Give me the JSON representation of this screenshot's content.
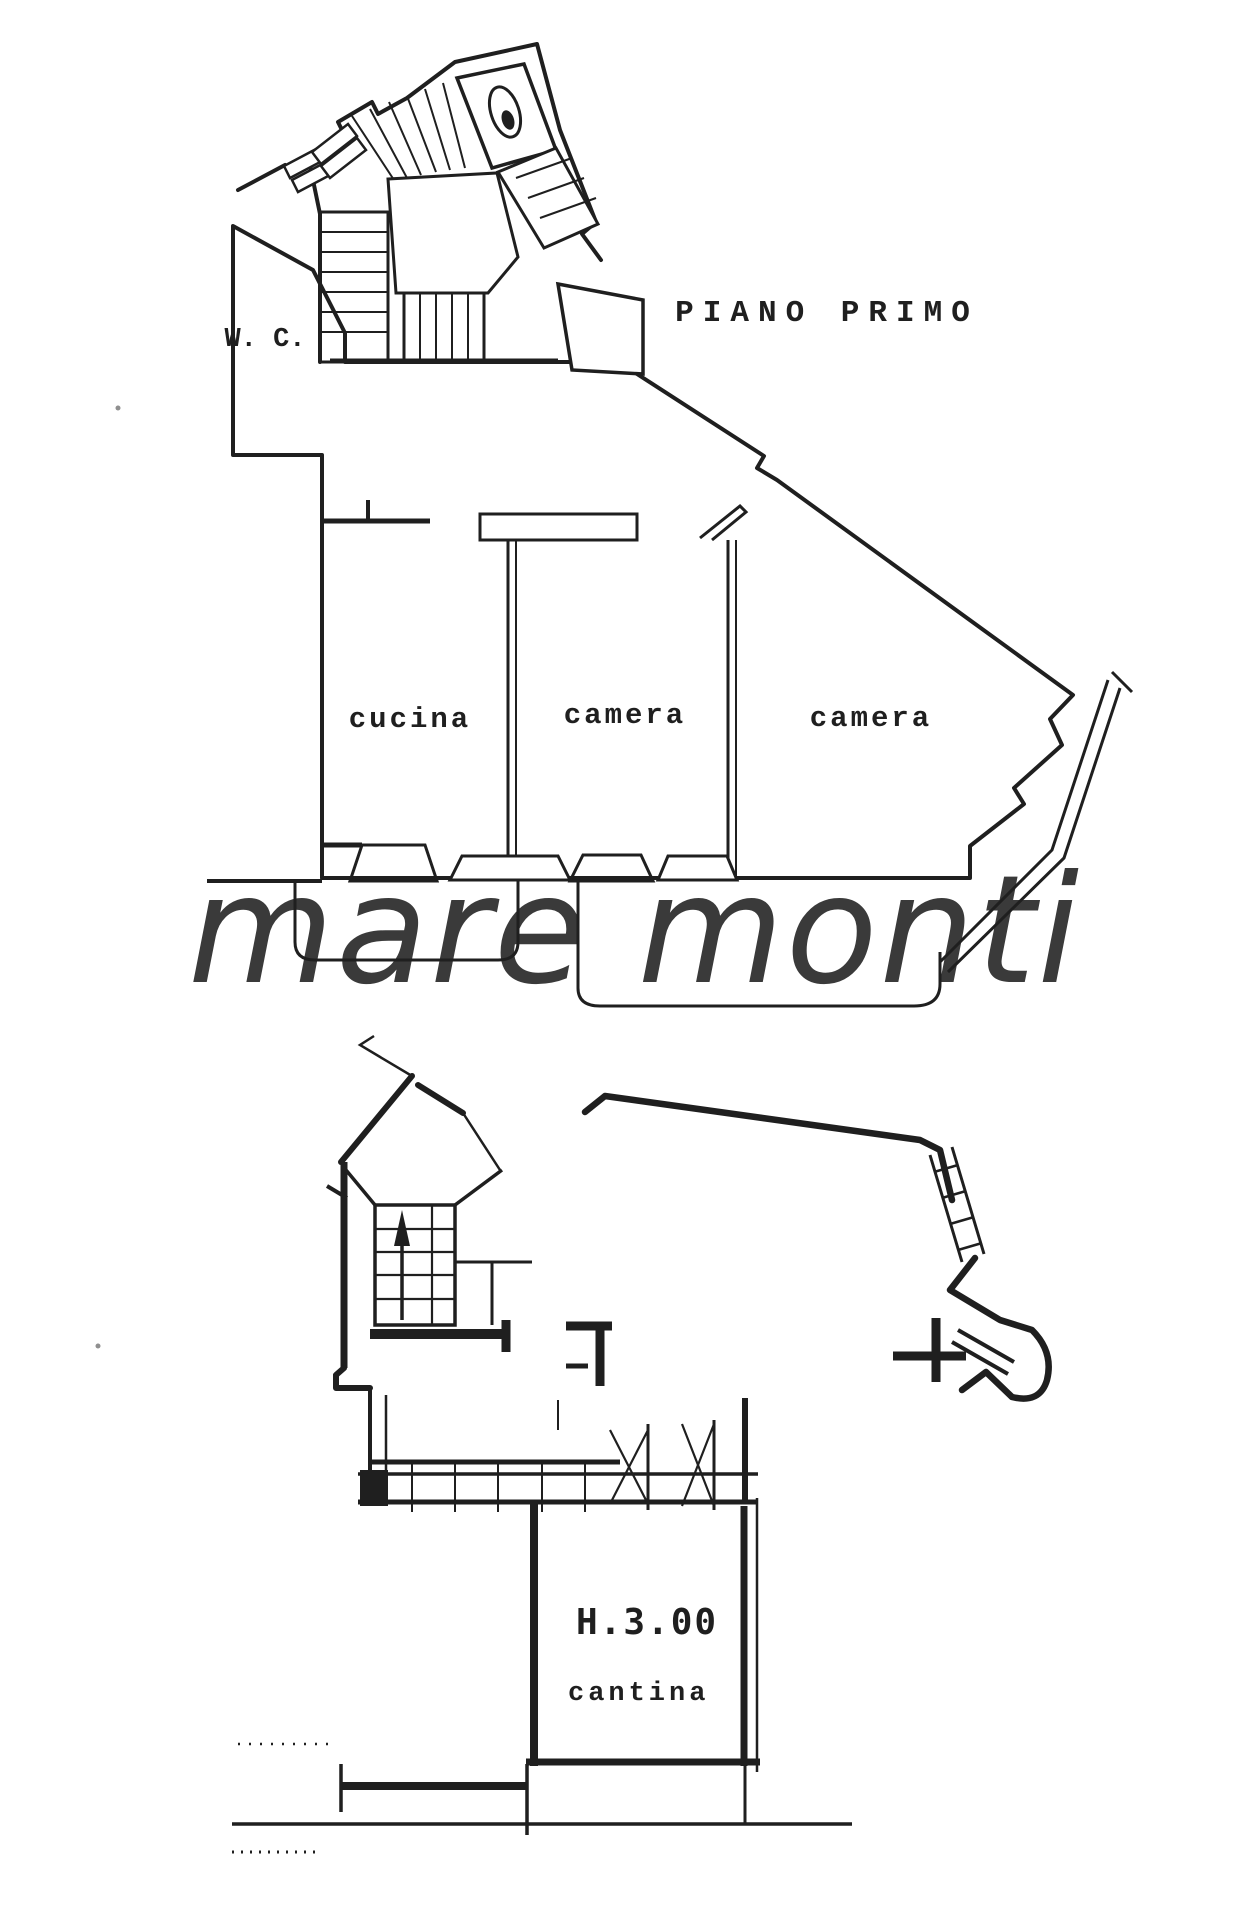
{
  "colors": {
    "highlight_yellow": "#F6E41E",
    "watermark_green": "#A6CF35",
    "ink": "#1f1f1f",
    "paper": "#ffffff"
  },
  "plans": {
    "first_floor": {
      "title": "PIANO PRIMO",
      "rooms": [
        {
          "label": "W. C."
        },
        {
          "label": "cucina"
        },
        {
          "label": "camera"
        },
        {
          "label": "camera"
        }
      ]
    },
    "basement": {
      "height_annotation": "H.3.00",
      "rooms": [
        {
          "label": "cantina"
        }
      ]
    }
  },
  "watermark": {
    "text": "mare monti"
  }
}
